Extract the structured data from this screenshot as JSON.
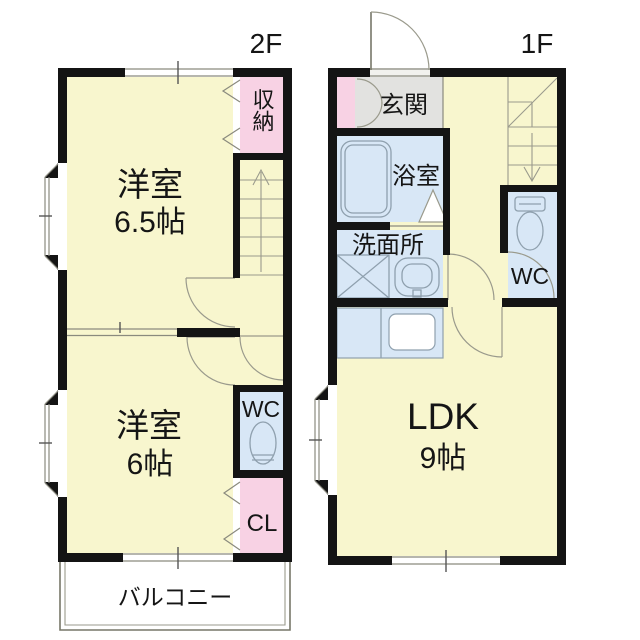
{
  "floor2": {
    "label": "2F",
    "room1": {
      "name": "洋室",
      "size": "6.5帖"
    },
    "closet_top": "収納",
    "room2": {
      "name": "洋室",
      "size": "6帖"
    },
    "wc": "WC",
    "closet_bottom": "CL",
    "balcony": "バルコニー"
  },
  "floor1": {
    "label": "1F",
    "entrance": "玄関",
    "bath": "浴室",
    "washroom": "洗面所",
    "wc": "WC",
    "ldk": {
      "name": "LDK",
      "size": "9帖"
    }
  },
  "colors": {
    "room_floor": "#F8F6CE",
    "closet": "#F8D2E4",
    "wet": "#D8E7F6",
    "entrance_floor": "#E2E2E0",
    "wall": "#141414",
    "line": "#8a8a7e",
    "text": "#151515"
  }
}
